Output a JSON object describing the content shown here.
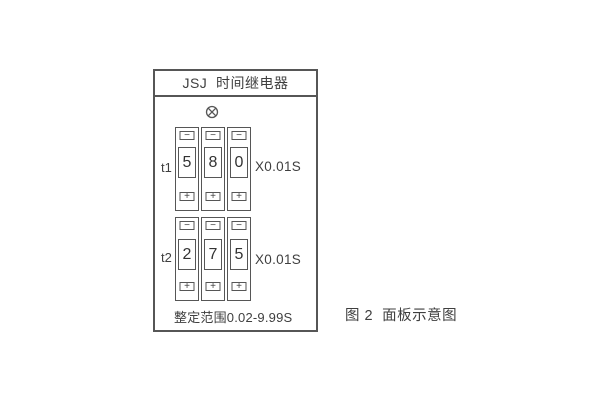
{
  "panel": {
    "title": "JSJ  时间继电器",
    "range_text": "整定范围0.02-9.99S",
    "groups": [
      {
        "label": "t1",
        "digits": [
          "5",
          "8",
          "0"
        ],
        "multiplier": "X0.01S"
      },
      {
        "label": "t2",
        "digits": [
          "2",
          "7",
          "5"
        ],
        "multiplier": "X0.01S"
      }
    ]
  },
  "symbols": {
    "minus": "−",
    "plus": "+"
  },
  "caption": "图 2  面板示意图",
  "colors": {
    "stroke": "#565656",
    "text": "#3f3f3f",
    "background": "#ffffff"
  }
}
